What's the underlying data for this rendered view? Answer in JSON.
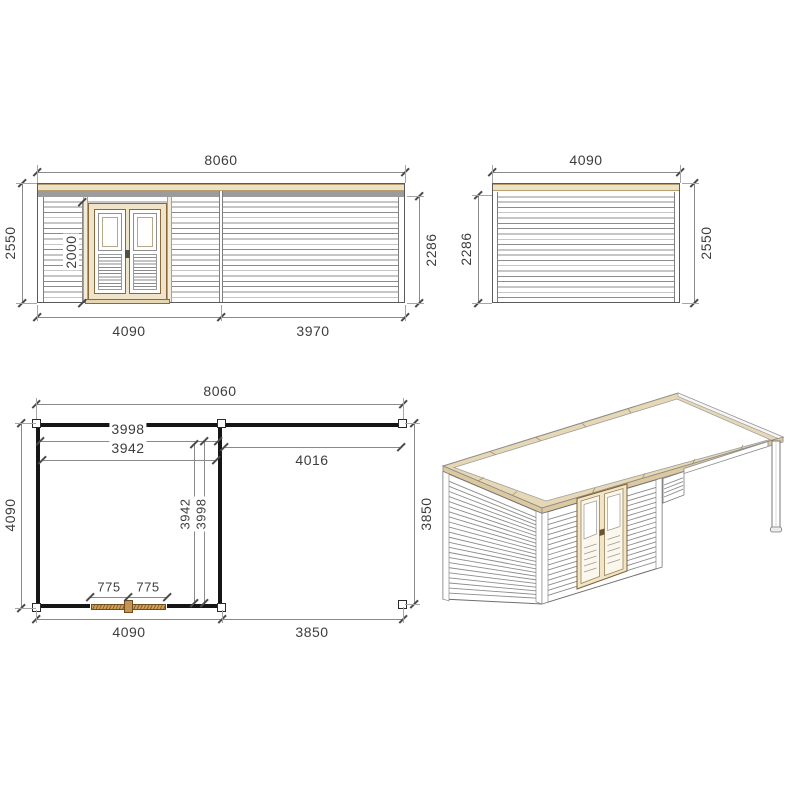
{
  "colors": {
    "paper": "#ffffff",
    "wood_trim": "#ece2c8",
    "wood_roof_rim": "#e7d8b5",
    "gray_band": "#9c9c9c",
    "siding_line": "#8c8c8c",
    "plan_wall": "#161616",
    "plan_door_wood": "#cf9f5c",
    "dimension_text": "#3d3d3d"
  },
  "front_elevation": {
    "width_total": "8060",
    "height_left": "2550",
    "door_height": "2000",
    "wall_height_right": "2286",
    "bottom_segments": [
      "4090",
      "3970"
    ]
  },
  "side_elevation": {
    "width_total": "4090",
    "wall_height_left": "2286",
    "height_right": "2550"
  },
  "floor_plan": {
    "width_total": "8060",
    "inner_width_a": "3998",
    "inner_width_b": "3942",
    "canopy_width": "4016",
    "depth_left": "4090",
    "inner_depth_a": "3942",
    "inner_depth_b": "3998",
    "depth_right": "3850",
    "door_leaves": [
      "775",
      "775"
    ],
    "bottom_segments": [
      "4090",
      "3850"
    ]
  }
}
